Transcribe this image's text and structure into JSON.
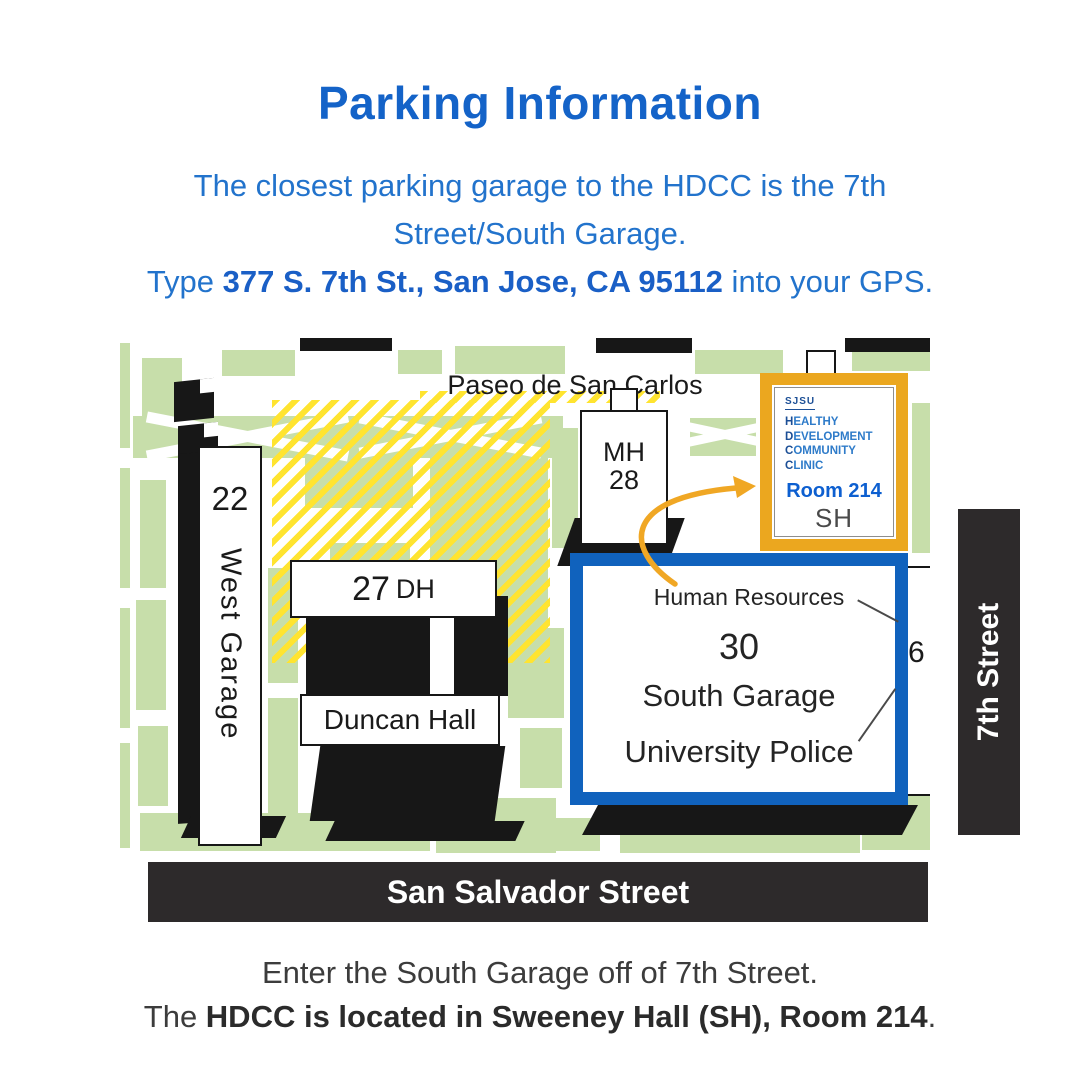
{
  "header": {
    "title": "Parking Information"
  },
  "intro": {
    "line1": "The closest parking garage to the HDCC is the 7th",
    "line2": "Street/South Garage.",
    "line3_prefix": "Type ",
    "line3_bold": "377 S. 7th St., San Jose, CA 95112",
    "line3_suffix": " into your GPS."
  },
  "map": {
    "street_top": "Paseo de San Carlos",
    "street_right": "7th Street",
    "street_bottom": "San Salvador Street",
    "buildings": {
      "west_garage_number": "22",
      "west_garage_name": "West Garage",
      "dh_number": "27",
      "dh_code": "DH",
      "duncan": "Duncan Hall",
      "mh_code": "MH",
      "mh_number": "28",
      "bldg26": "26"
    },
    "south_garage_box": {
      "line1": "Human Resources",
      "line2": "30",
      "line3": "South Garage",
      "line4": "University Police"
    },
    "hdcc_box": {
      "logo": "SJSU",
      "lines": [
        {
          "b": "H",
          "r": "EALTHY"
        },
        {
          "b": "D",
          "r": "EVELOPMENT"
        },
        {
          "b": "C",
          "r": "OMMUNITY"
        },
        {
          "b": "C",
          "r": "LINIC"
        }
      ],
      "room": "Room 214",
      "hall": "SH"
    }
  },
  "footer": {
    "line1": "Enter the South Garage off of 7th Street.",
    "line2_prefix": "The ",
    "line2_bold": "HDCC is located in Sweeney Hall (SH), Room 214",
    "line2_suffix": "."
  },
  "colors": {
    "title_blue": "#1463C8",
    "body_blue": "#2273CC",
    "map_green": "#C7DEAA",
    "hatch_yellow": "#FFE430",
    "sjsu_gold": "#EBA71F",
    "garage_blue": "#1062BD",
    "arrow_orange": "#F0A724",
    "banner_dark": "#2D2A2B",
    "room_blue": "#0D5FD0",
    "navy": "#1C4F96"
  }
}
